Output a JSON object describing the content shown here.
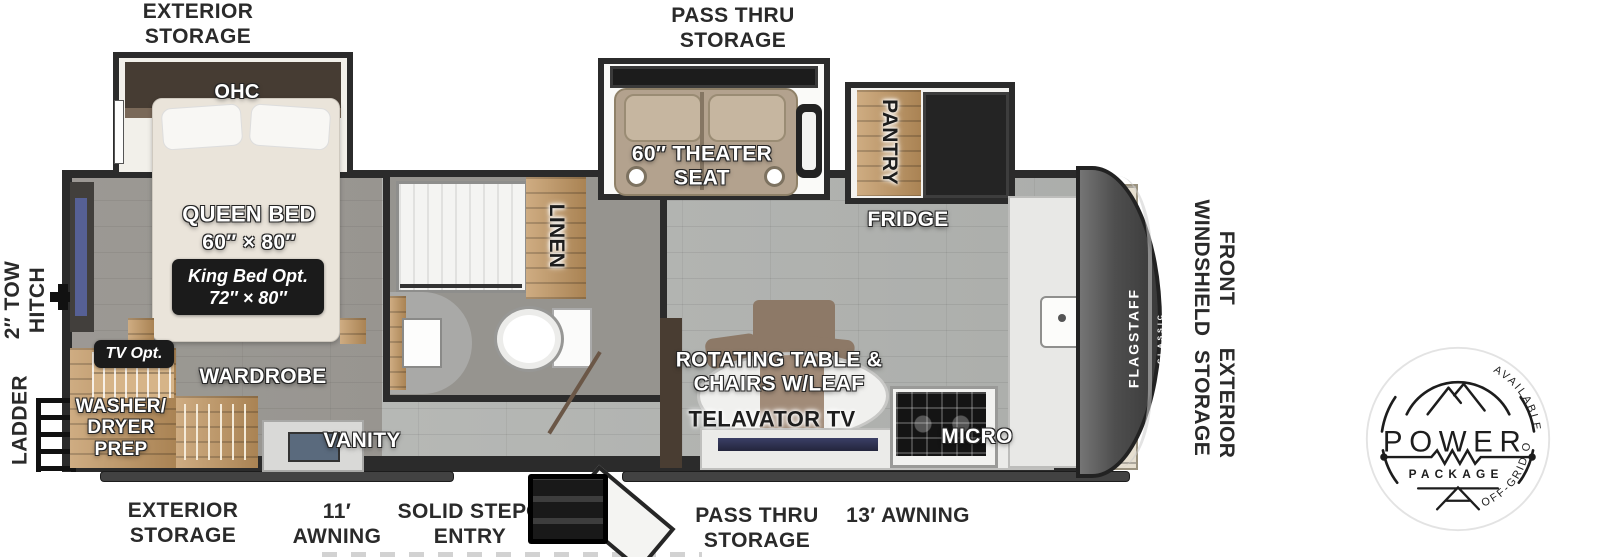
{
  "plan": {
    "brand": "FLAGSTAFF",
    "brand_sub": "CLASSIC",
    "top_labels": {
      "exterior_storage": "EXTERIOR\nSTORAGE",
      "pass_thru_storage": "PASS THRU\nSTORAGE"
    },
    "bottom_labels": {
      "exterior_storage": "EXTERIOR\nSTORAGE",
      "awning_11": "11′\nAWNING",
      "solid_step_entry": "SOLID STEP®\nENTRY",
      "pass_thru_storage": "PASS THRU\nSTORAGE",
      "awning_13": "13′ AWNING"
    },
    "left_labels": {
      "tow_hitch": "2″ TOW\nHITCH",
      "ladder": "LADDER"
    },
    "right_labels": {
      "front_windshield": "FRONT\nWINDSHIELD",
      "exterior_storage": "EXTERIOR\nSTORAGE"
    },
    "rooms": {
      "ohc_bedroom": "OHC",
      "queen_bed": "QUEEN BED",
      "queen_bed_size": "60″ × 80″",
      "king_bed_opt": "King Bed Opt.",
      "king_bed_size": "72″ × 80″",
      "tv_opt": "TV Opt.",
      "wardrobe": "WARDROBE",
      "washer_dryer_prep": "WASHER/\nDRYER\nPREP",
      "vanity": "VANITY",
      "linen": "LINEN",
      "theater_seat": "60″ THEATER\nSEAT",
      "pantry": "PANTRY",
      "fridge": "FRIDGE",
      "rotating_table": "ROTATING TABLE &\nCHAIRS W/LEAF",
      "telavator_tv": "TELAVATOR TV",
      "micro": "MICRO",
      "ohc_front": "OHC"
    },
    "badge": {
      "top": "AVAILABLE WITH",
      "power": "POWER",
      "package": "PACKAGE",
      "bottom": "OFF-GRID OPTIONS"
    }
  }
}
